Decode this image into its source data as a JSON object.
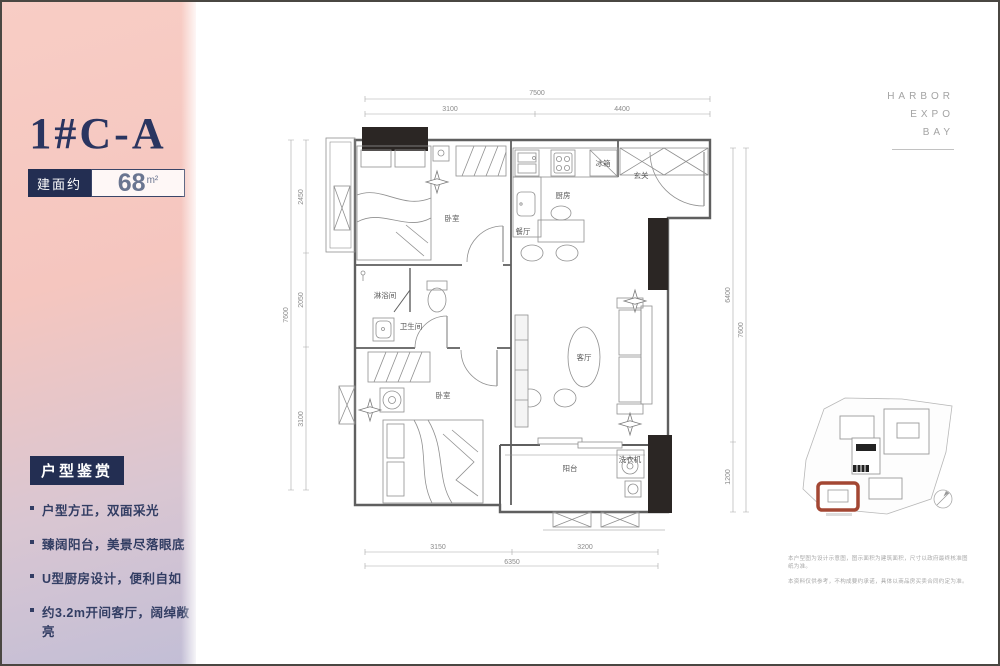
{
  "panel": {
    "title": "1#C-A",
    "area_label": "建面约",
    "area_value": "68",
    "area_unit": "m²",
    "section_title": "户型鉴赏",
    "features": [
      "户型方正，双面采光",
      "臻阔阳台，美景尽落眼底",
      "U型厨房设计，便利自如",
      "约3.2m开间客厅，阔绰敞亮"
    ],
    "colors": {
      "gradient_top": "#f8cdc5",
      "gradient_bottom": "#c2bed6",
      "accent_navy": "#232e52"
    }
  },
  "brand": {
    "lines": [
      "HARBOR",
      "EXPO",
      "BAY"
    ]
  },
  "plan": {
    "labels": {
      "bedroom1": "卧室",
      "kitchen": "厨房",
      "dining": "餐厅",
      "entry": "玄关",
      "fridge": "冰箱",
      "living": "客厅",
      "shower": "淋浴间",
      "bathroom": "卫生间",
      "bedroom2": "卧室",
      "balcony": "阳台",
      "washer": "洗衣机"
    },
    "dims": {
      "top_total": "7500",
      "top_seg1": "3100",
      "top_seg2": "4400",
      "left_total": "7600",
      "left_seg1": "2450",
      "left_seg2": "2050",
      "left_seg3": "3100",
      "right_total": "7600",
      "right_seg1": "6400",
      "right_seg2": "1200",
      "bottom_total": "6350",
      "bottom_seg1": "3150",
      "bottom_seg2": "3200"
    }
  },
  "disclaimer": {
    "line1": "本户型图为设计示意图，图示面积为建筑面积，尺寸以政府最终核准图纸为准。",
    "line2": "本资料仅供参考，不构成要约承诺，具体以商品房买卖合同约定为准。"
  }
}
